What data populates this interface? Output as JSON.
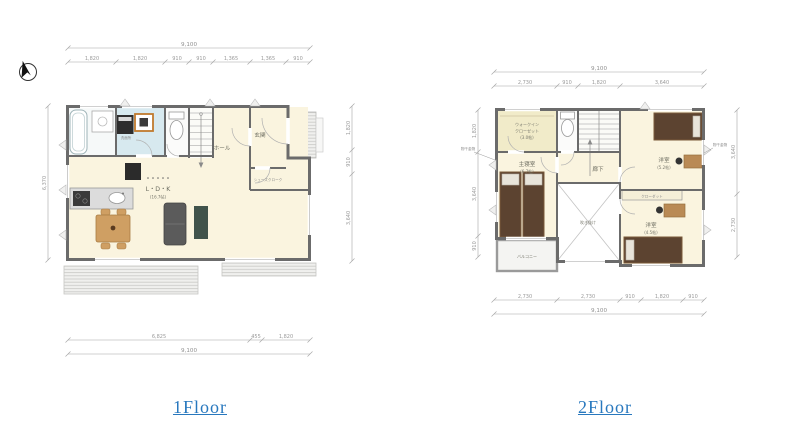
{
  "page": {
    "background": "#ffffff"
  },
  "icons": {
    "north_arrow": "compass-north-arrow"
  },
  "colors": {
    "caption_blue": "#2878be",
    "wall_gray": "#6b6b6b",
    "floor_cream": "#faf4df",
    "washroom_blue": "#d7e9ef",
    "wic_yellow": "#f1ebc9",
    "bed_brown": "#5c4330",
    "wood": "#cf9f63",
    "sofa_gray": "#5b5b5b",
    "dim_gray": "#9a9a9a"
  },
  "captions": {
    "floor1": "1Floor",
    "floor2": "2Floor"
  },
  "floor1": {
    "labels": {
      "washroom": "洗面所",
      "hall": "ホール",
      "entrance": "玄関",
      "shoe_closet": "シューズクローク",
      "ldk_line1": "L・D・K",
      "ldk_line2": "(16.7帖)"
    },
    "dims": {
      "top": {
        "total": "9,100",
        "segments": [
          "1,820",
          "1,820",
          "910",
          "910",
          "1,365",
          "1,365",
          "910"
        ]
      },
      "bottom": {
        "total": "9,100",
        "segments": [
          "6,825",
          "455",
          "1,820"
        ]
      },
      "left": {
        "total": "6,370"
      },
      "right": {
        "segments": [
          "1,820",
          "910",
          "3,640"
        ]
      }
    }
  },
  "floor2": {
    "labels": {
      "wic_line1": "ウォークイン",
      "wic_line2": "クローゼット",
      "wic_line3": "(3.0帖)",
      "master_line1": "主寝室",
      "master_line2": "(6.7帖)",
      "hallway": "廊下",
      "room1_line1": "洋室",
      "room1_line2": "(5.2帖)",
      "room2_line1": "洋室",
      "room2_line2": "(4.5帖)",
      "void": "吹き抜け",
      "balcony": "バルコニー",
      "closet": "クローゼット",
      "laundry_left": "物干金物",
      "laundry_right": "物干金物"
    },
    "dims": {
      "top": {
        "total": "9,100",
        "segments": [
          "2,730",
          "910",
          "1,820",
          "3,640"
        ]
      },
      "bottom": {
        "total": "9,100",
        "segments": [
          "2,730",
          "2,730",
          "910",
          "1,820",
          "910"
        ]
      },
      "left": {
        "segments": [
          "1,820",
          "3,640",
          "910"
        ]
      },
      "right": {
        "segments": [
          "3,640",
          "2,730"
        ]
      }
    }
  }
}
